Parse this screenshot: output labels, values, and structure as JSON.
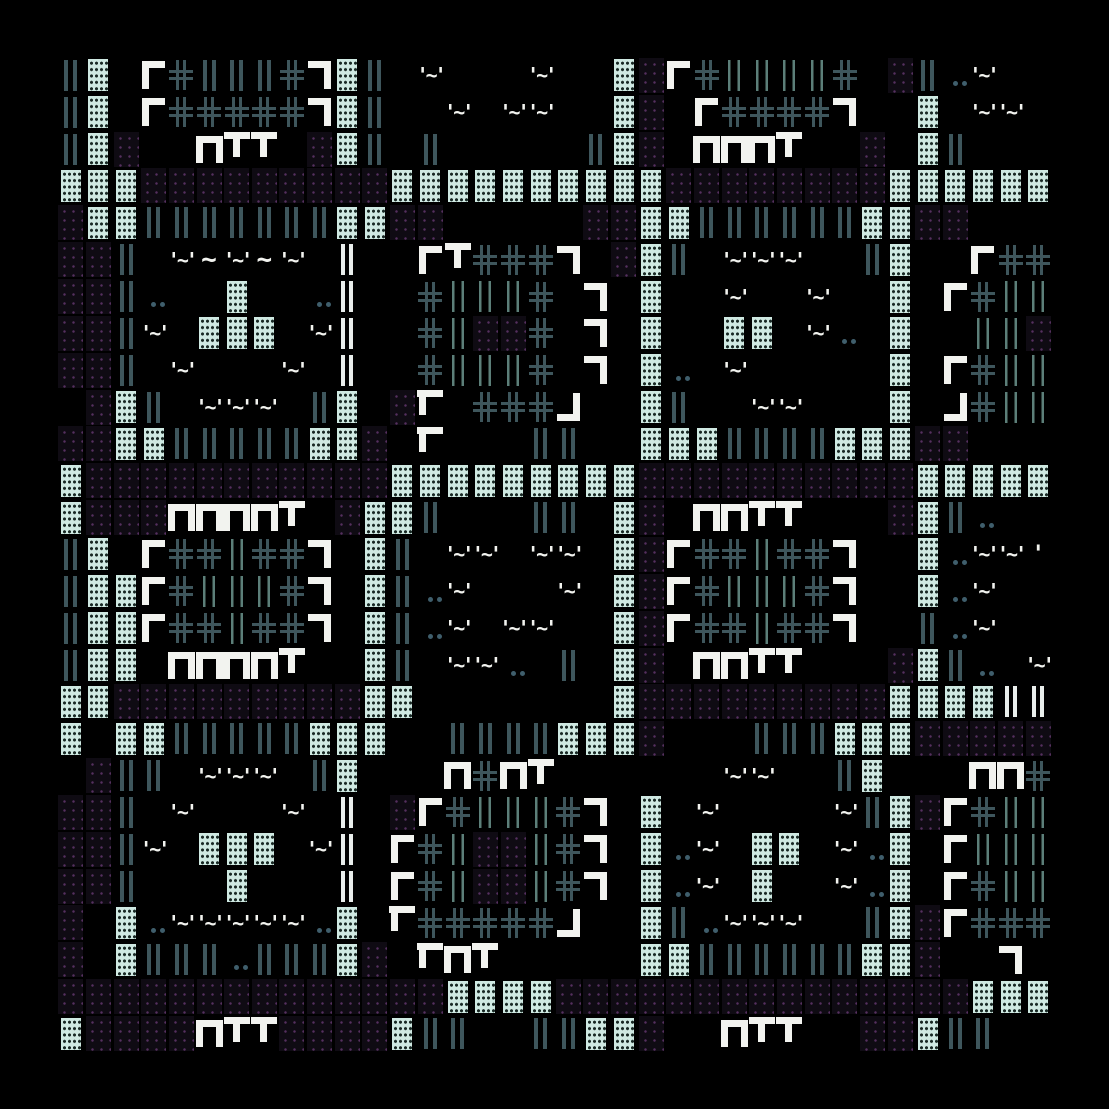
{
  "canvas": {
    "width": 1109,
    "height": 1109,
    "background": "#000000",
    "grid": {
      "left": 57,
      "top": 57,
      "cols": 36,
      "rows": 27,
      "cell_w": 27.64,
      "cell_h": 36.85
    }
  },
  "palette": {
    "mint_block": "#cfe9e2",
    "mint_texture": "#182824",
    "slate_bars": "#3e565c",
    "thin_bars": "#5c7f79",
    "white_glyph": "#f2f3ef",
    "white_bars": "#e9eeec",
    "violet_block_base": "#0f0b13",
    "violet_dot": "#55305f",
    "steel_dot": "#3f5e6c"
  },
  "legend": {
    "b": "mint-block",
    "p": "violet-dot-block",
    "|": "slate-double-bar",
    "i": "thin-bar-pair",
    "I": "white-double-bar",
    "+": "slate-double-cross",
    "r": "white-corner-tl",
    "7": "white-corner-tr",
    "L": "white-corner-bl",
    "j": "white-corner-br",
    "n": "white-pi-shape",
    "t": "white-tee-shape",
    "m": "white-tee-left",
    "e": "white-eye",
    "~": "white-tilde",
    "q": "white-tick",
    "d": "steel-dot-pair",
    ".": "empty"
  },
  "glyph_text": {
    "e": "'~'",
    "~": "~",
    "q": "'"
  },
  "rows": [
    "|b.r+|||+7b|.e...e..bpr+iiii+.p|de..",
    "|b.r+++++7b|..e.ee..bp.r++++7..b.ee.",
    "|bp..ntt.pb|.|.....|bp.nnnt..p.b|...",
    "bbbpppppppppbbbbbbbbbbppppppppbbbbbb",
    "pbb|||||||bbpp.....ppbb||||||bbpp...",
    "pp|.e~e~e.I..rt+++7.pb|.eee..|b..r++",
    "pp|d..b..dI..+iii+.7.b..e..e..b.r+ii",
    "pp|e.bbb.eI..+ipp+.7.b..bb.ed.b..iip",
    "pp|.e...e.I..+iii+.7.bd.e.....b.r+ii",
    ".pb|.eee.|b.pm.+++j..b|..ee...b.j+ii",
    "ppbb|||||bbp.m...||..bbb||||bbbpp...",
    "bpppppppppppbbbbbbbbbppppppppppbbbbb",
    "bpppnnnnt.pbb|...||.bp.nntt...pb|d..",
    "|b.r++i++7.b|.ee.ee.bpr++i++7..bdeeq",
    "|bbr+iii+7.b|de...e.bpr+iii+7..bde..",
    "|bbr++i++7.b|de.ee..bpr++i++7..|de..",
    "|bb.nnnnt..b|.eed.|.bp.nntt...pb|d.e",
    "bbpppppppppbb.......bpppppppppbbbbII",
    "b.bb|||||bbb..||||bbbp...|||bbbppppp",
    ".p||.eee.|b...n+nt......ee..|b...nn+",
    "pp|.e...e.I.pr+iii+7.b.e....e|bpr+ii",
    "pp|e.bbb.eI.r+ippi+7.bde.bb.edb.riii",
    "pp|...b...I.r+ippi+7.bde.b..edb.r+ii",
    "p.bdeeeeedb.m+++++j..b|deee..|bpr+++",
    "p.b|||d|||bp.mnt.....bb||||||bbp..7.",
    "ppppppppppppppbbbbpppppppppppppppbbb",
    "bppppnttppppb||..||bbp..ntt..ppb||.."
  ]
}
